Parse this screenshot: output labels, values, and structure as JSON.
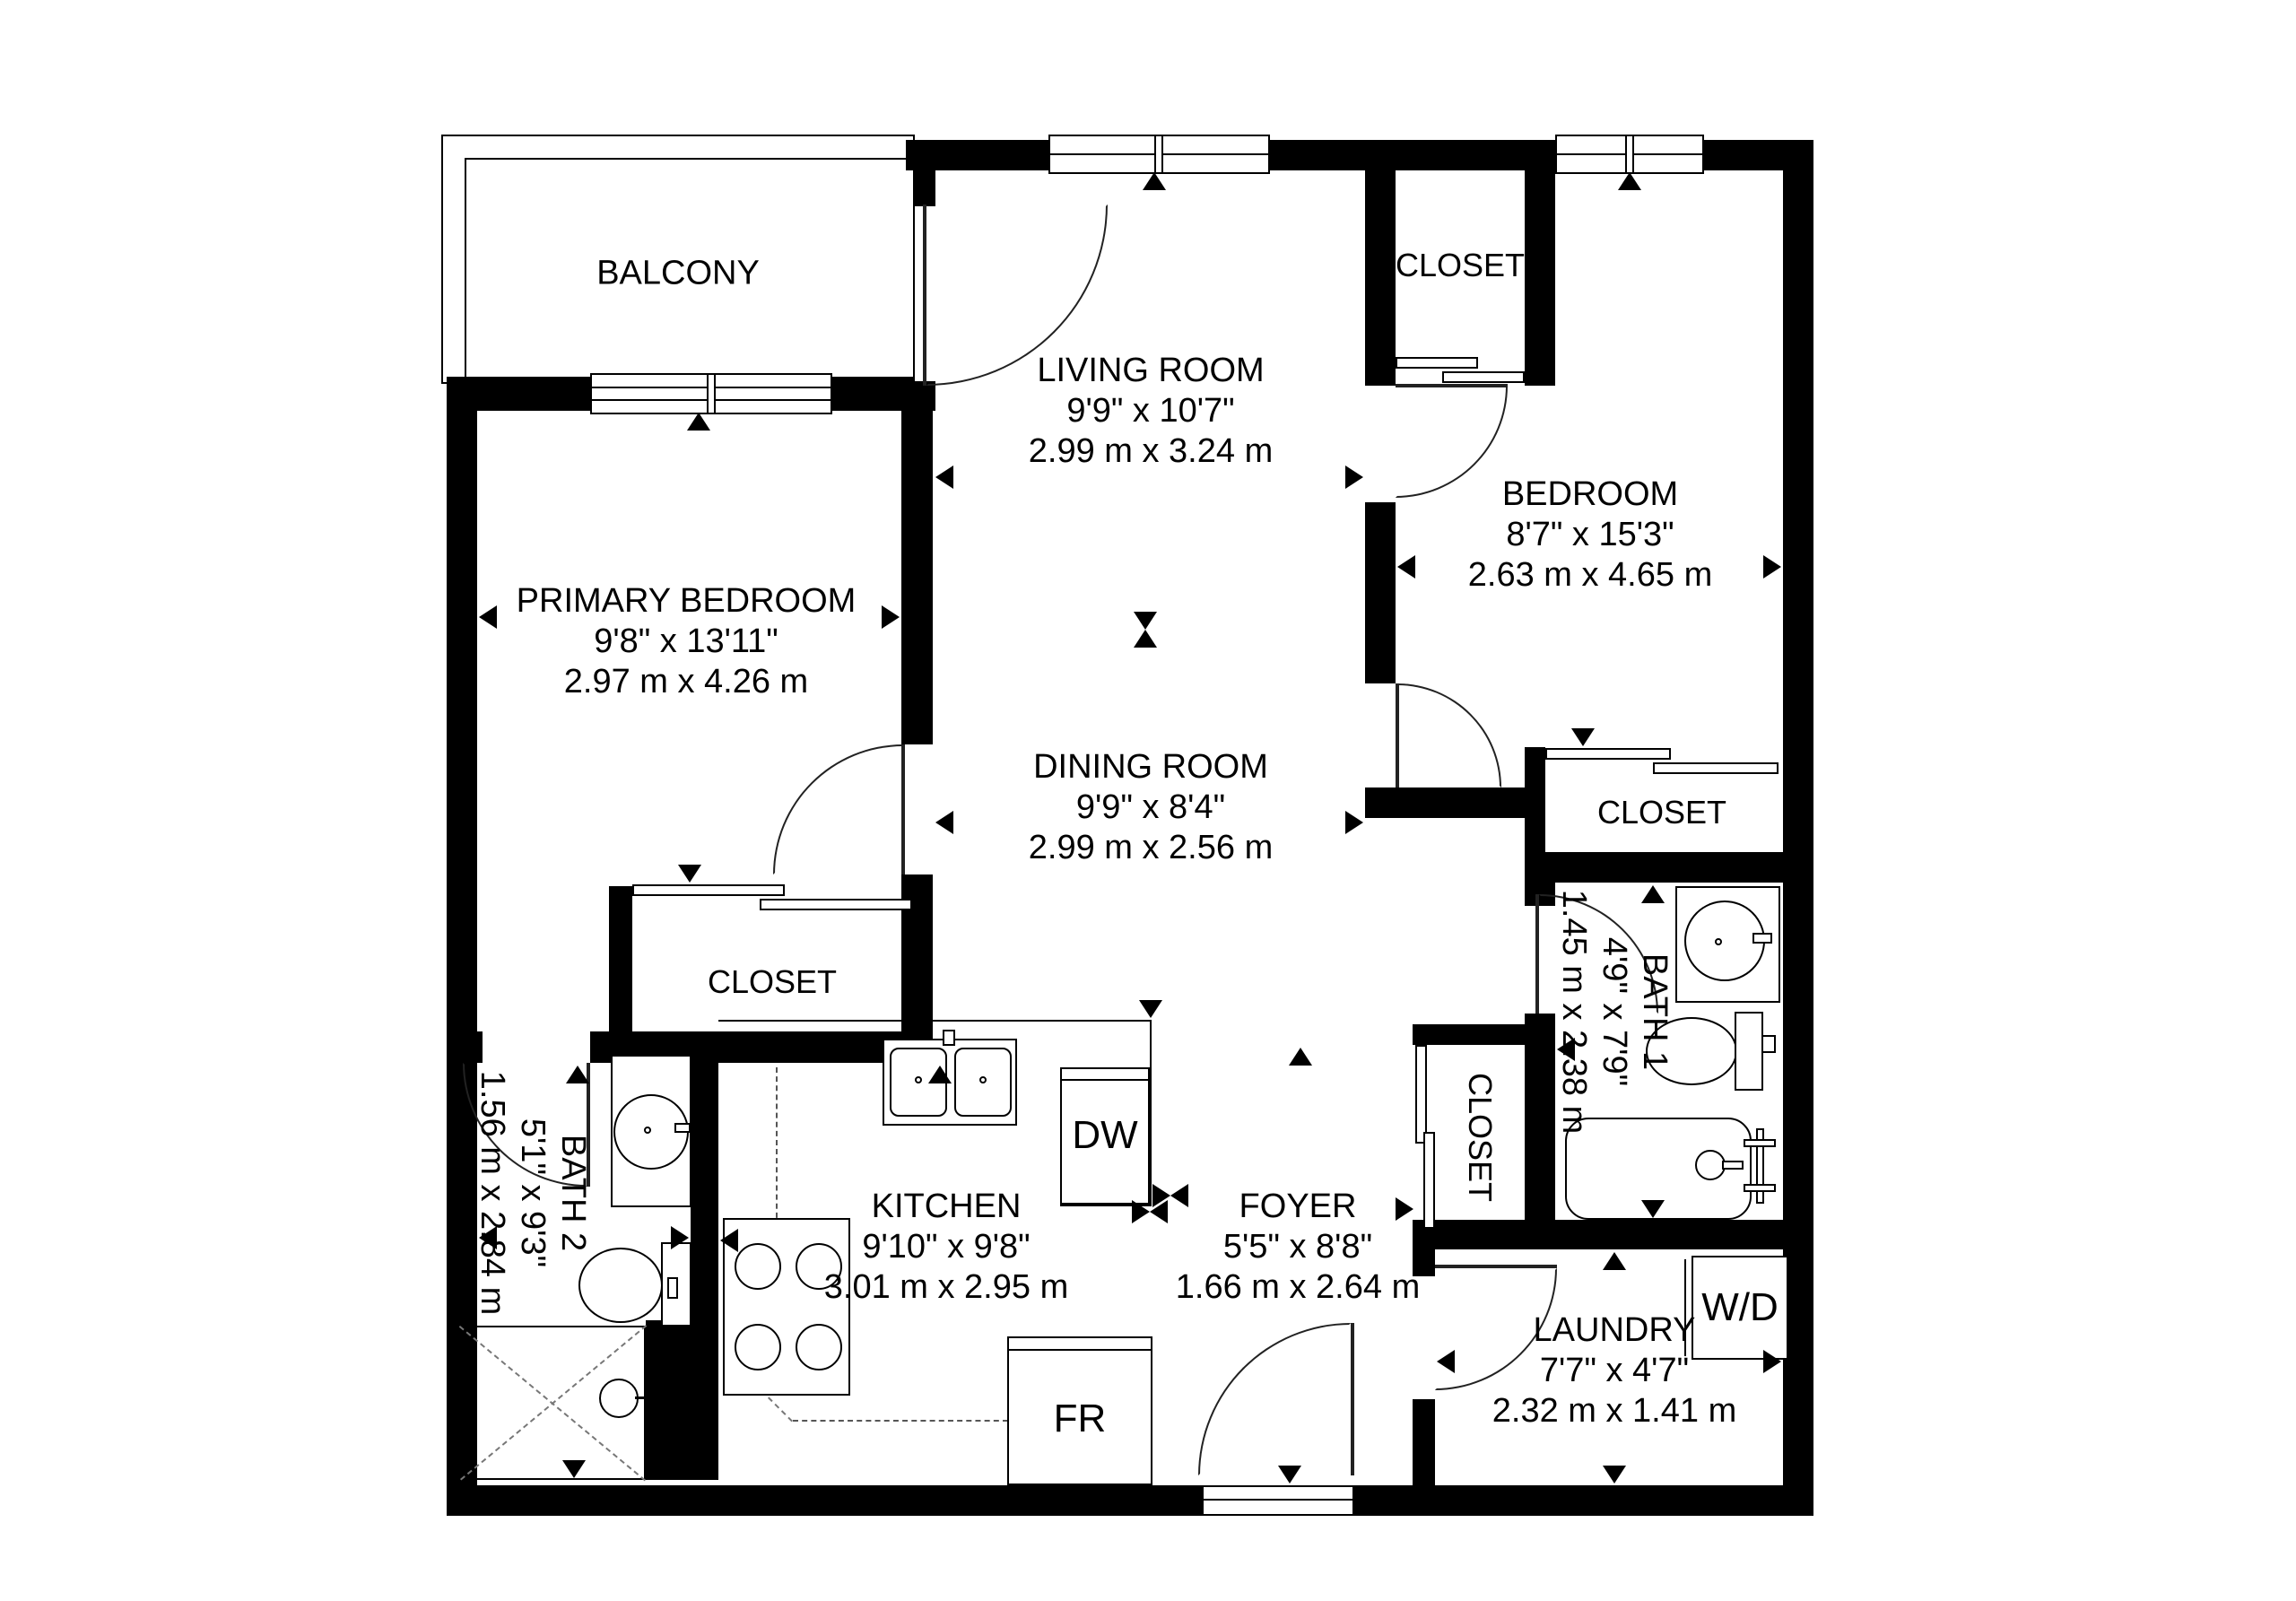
{
  "balcony_label": "BALCONY",
  "rooms": {
    "living": {
      "name": "LIVING ROOM",
      "imperial": "9'9\" x 10'7\"",
      "metric": "2.99 m x 3.24 m"
    },
    "dining": {
      "name": "DINING ROOM",
      "imperial": "9'9\" x 8'4\"",
      "metric": "2.99 m x 2.56 m"
    },
    "primary": {
      "name": "PRIMARY BEDROOM",
      "imperial": "9'8\" x 13'11\"",
      "metric": "2.97 m x 4.26 m"
    },
    "bedroom": {
      "name": "BEDROOM",
      "imperial": "8'7\" x 15'3\"",
      "metric": "2.63 m x 4.65 m"
    },
    "kitchen": {
      "name": "KITCHEN",
      "imperial": "9'10\" x 9'8\"",
      "metric": "3.01 m x 2.95 m"
    },
    "foyer": {
      "name": "FOYER",
      "imperial": "5'5\" x 8'8\"",
      "metric": "1.66 m x 2.64 m"
    },
    "bath1": {
      "name": "BATH 1",
      "imperial": "4'9\" x 7'9\"",
      "metric": "1.45 m x 2.38 m"
    },
    "bath2": {
      "name": "BATH 2",
      "imperial": "5'1\" x 9'3\"",
      "metric": "1.56 m x 2.84 m"
    },
    "laundry": {
      "name": "LAUNDRY",
      "imperial": "7'7\" x 4'7\"",
      "metric": "2.32 m x 1.41 m"
    }
  },
  "closets": [
    "CLOSET",
    "CLOSET",
    "CLOSET",
    "CLOSET"
  ],
  "appliances": {
    "dishwasher": "DW",
    "fridge": "FR",
    "washer_dryer": "W/D"
  }
}
